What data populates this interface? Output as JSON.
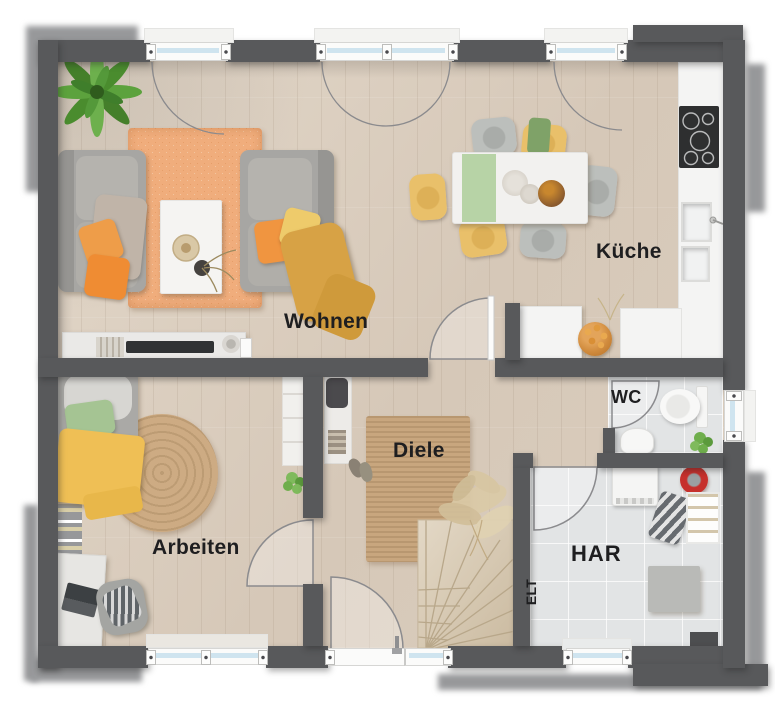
{
  "floorplan": {
    "rooms": [
      {
        "id": "wohnen",
        "label": "Wohnen"
      },
      {
        "id": "kueche",
        "label": "Küche"
      },
      {
        "id": "wc",
        "label": "WC"
      },
      {
        "id": "diele",
        "label": "Diele"
      },
      {
        "id": "arbeiten",
        "label": "Arbeiten"
      },
      {
        "id": "har",
        "label": "HAR"
      },
      {
        "id": "elt",
        "label": "ELT"
      }
    ],
    "palette": {
      "wall": "#58595b",
      "wall_shadow": "#97989a",
      "wood_floor": "#d8cbbc",
      "tile_floor": "#e2e4e5",
      "counter_white": "#f4f4f3",
      "window_glass": "#cfe4ef",
      "rug_orange": "#f0ad7c",
      "rug_jute": "#c8a67e",
      "accent_orange": "#ee9340",
      "accent_yellow": "#ecc367",
      "accent_green": "#a5c493",
      "accent_red": "#c6302c",
      "cooktop_black": "#2e2f30",
      "label_text": "#1e1e20"
    }
  }
}
